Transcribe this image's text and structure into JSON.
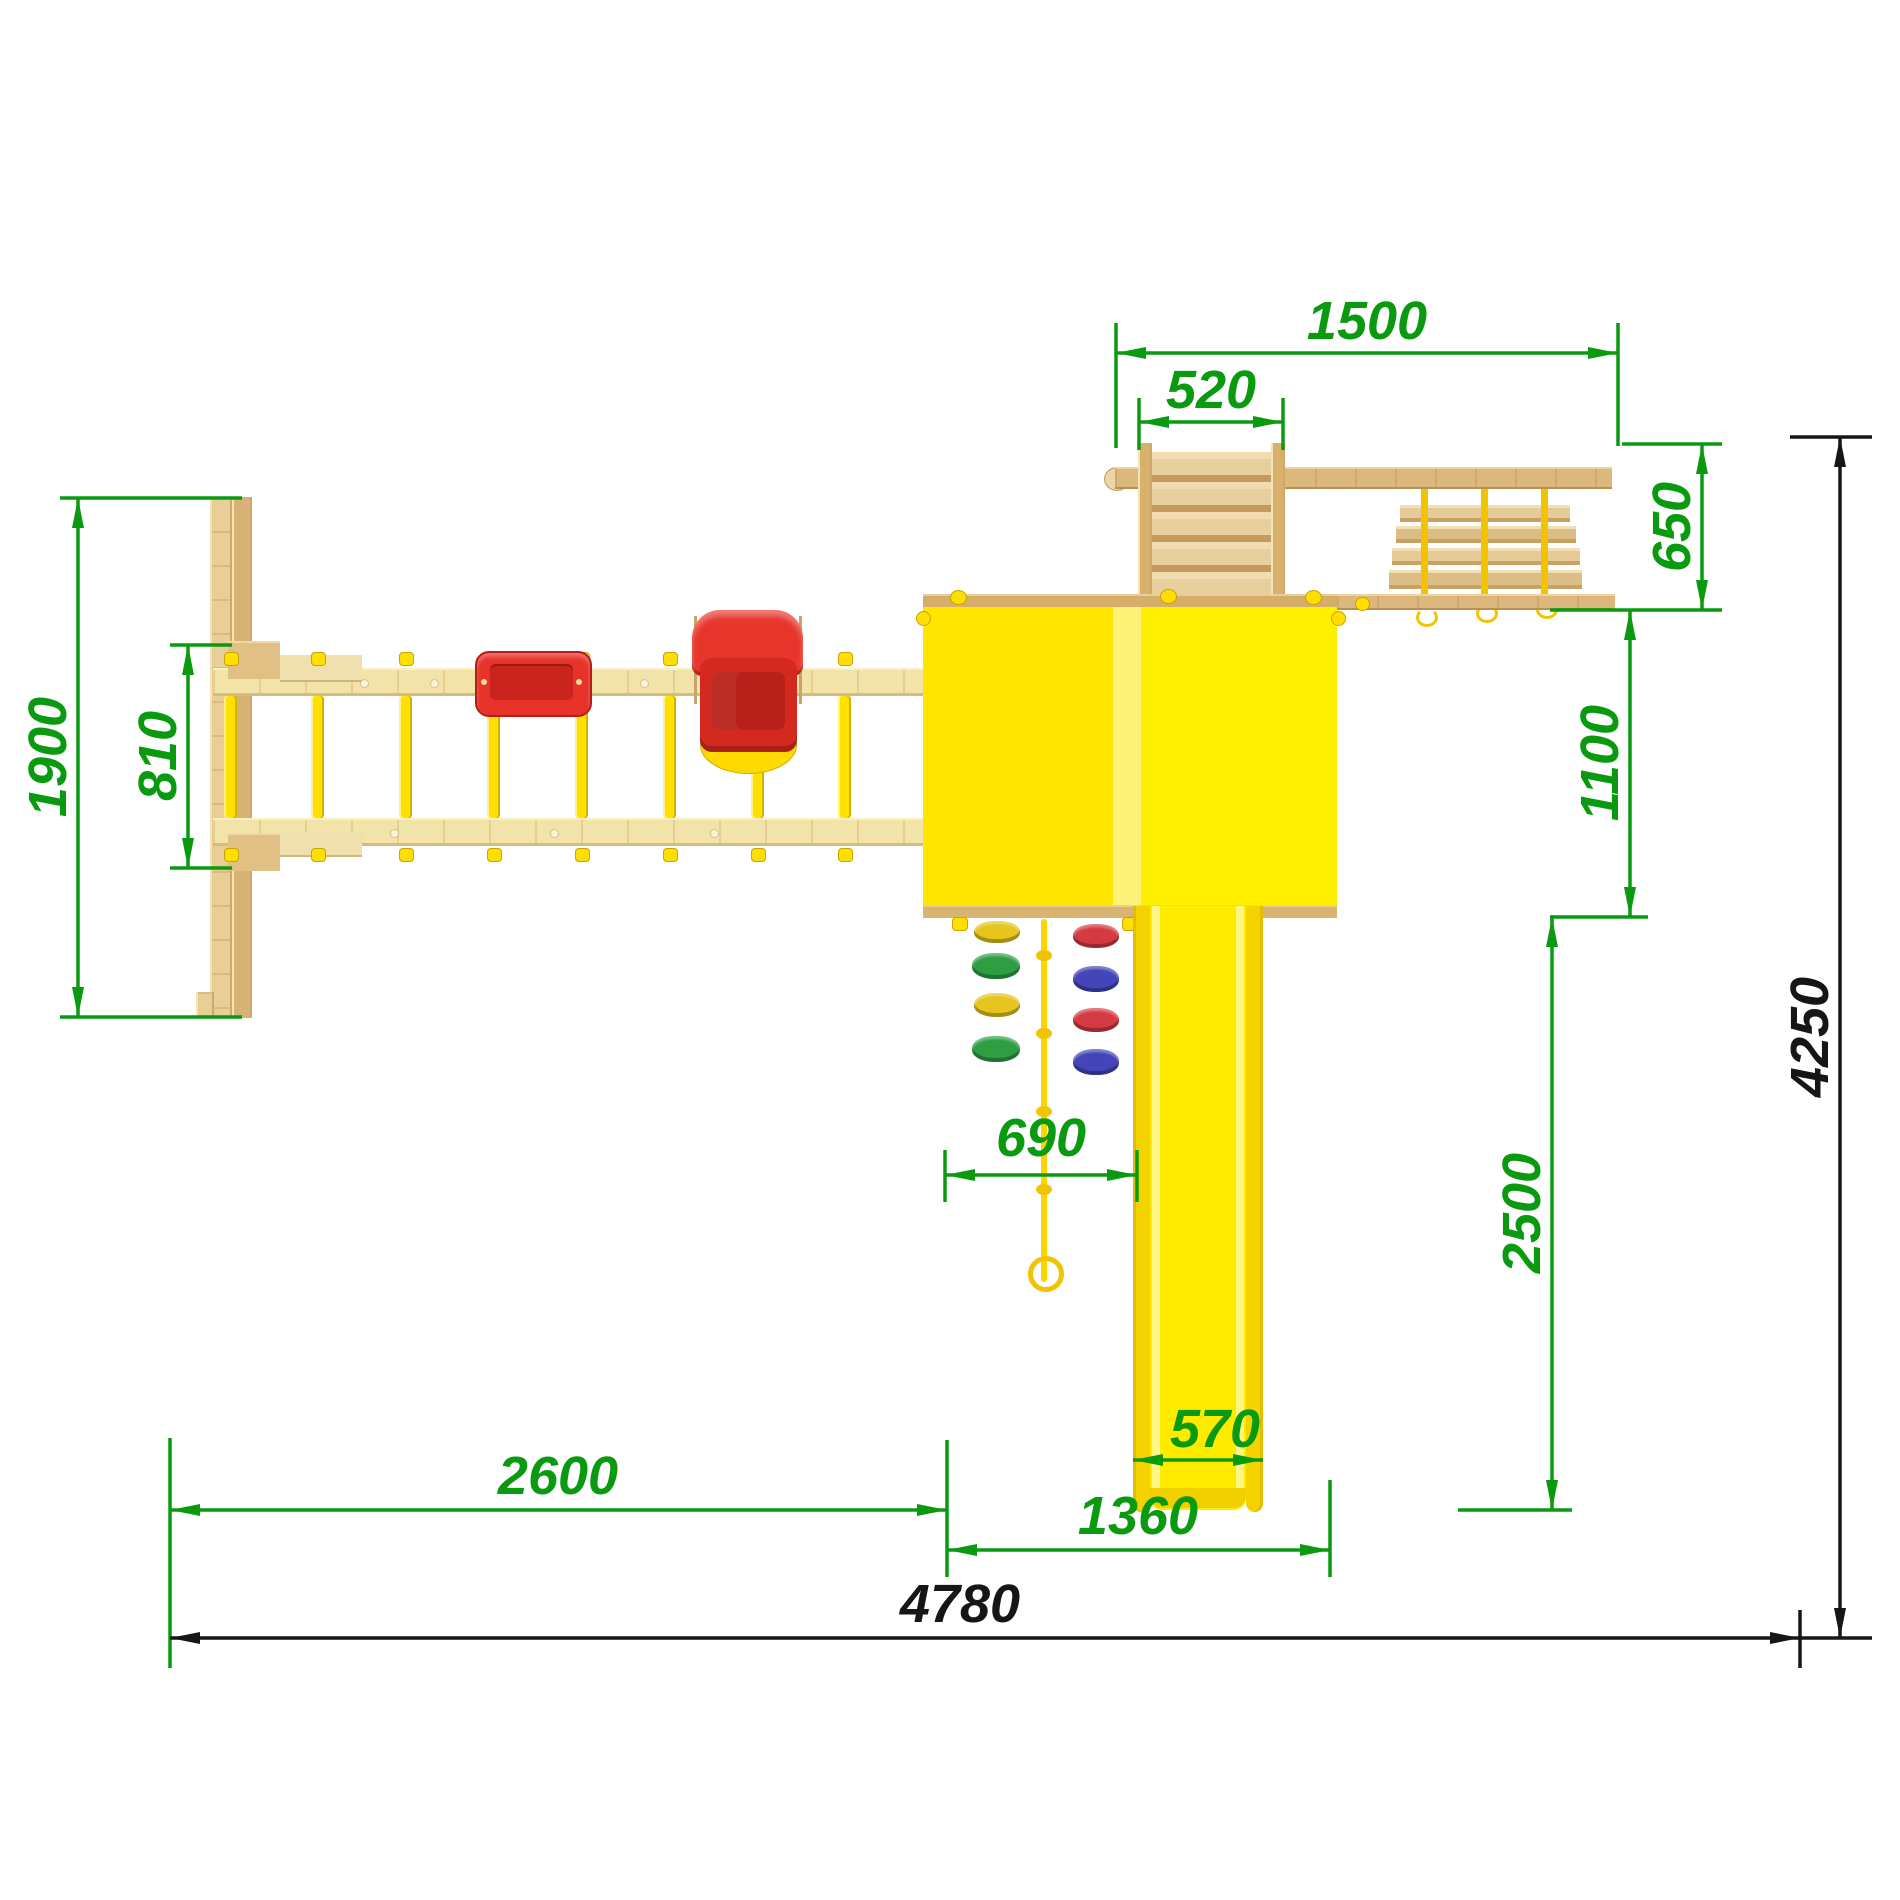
{
  "drawing": {
    "kind": "technical-plan-drawing",
    "view": "top-view-playground-set"
  },
  "colors": {
    "dimension_green": "#0a9a10",
    "dimension_black": "#161616",
    "tower_yellow": "#ffec00",
    "slide_yellow": "#ffeb00",
    "rung_yellow": "#ffe000",
    "rope_yellow": "#f1c300",
    "seat_red": "#e63228",
    "wood_light": "#f2e4a9",
    "wood_tan": "#dcb87c"
  },
  "dims": {
    "w1500": "1500",
    "w520": "520",
    "d650": "650",
    "d1100": "1100",
    "d2500": "2500",
    "h4250": "4250",
    "h1900": "1900",
    "h810": "810",
    "w690": "690",
    "w2600": "2600",
    "w1360": "1360",
    "w570": "570",
    "w4780": "4780"
  },
  "components": {
    "swing_seats": [
      "flat-seat",
      "baby-seat"
    ],
    "climb_holds_left": [
      "yellow",
      "green",
      "yellow",
      "green"
    ],
    "climb_holds_right": [
      "red",
      "blue",
      "red",
      "blue"
    ]
  }
}
